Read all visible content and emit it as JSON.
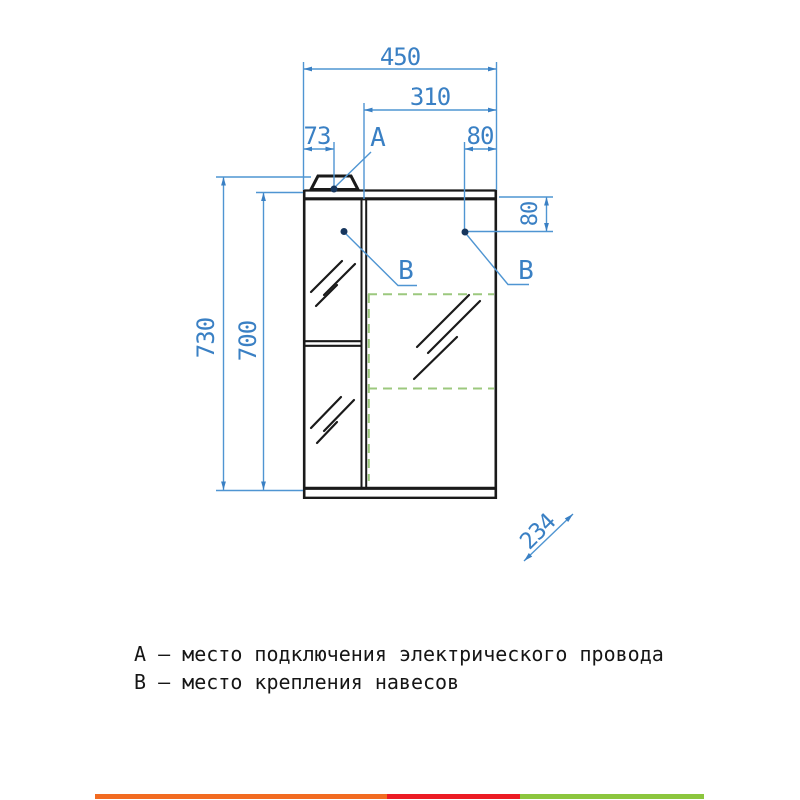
{
  "drawing": {
    "title": "cabinet-dimension-drawing",
    "dims": {
      "width_total": "450",
      "width_right_door": "310",
      "left_offset": "73",
      "right_offset": "80",
      "side_depth_offset": "80",
      "height_total": "730",
      "height_body": "700",
      "depth": "234"
    },
    "callouts": {
      "a": "А",
      "b_left": "В",
      "b_right": "В"
    },
    "legend": {
      "line1": "А – место подключения электрического провода",
      "line2": "В – место крепления навесов"
    },
    "colors": {
      "dimension_text_blue": "#3a80c4",
      "dimension_line_blue": "#4f95d2",
      "callout_dot_navy": "#17365d",
      "mirror_zone_dashed_green": "#9cc87e",
      "drawing_line_black": "#1a1a1a",
      "footer_bar_orange": "#f26b21",
      "footer_bar_red": "#ec1c24",
      "footer_bar_green": "#8cc63e"
    }
  }
}
